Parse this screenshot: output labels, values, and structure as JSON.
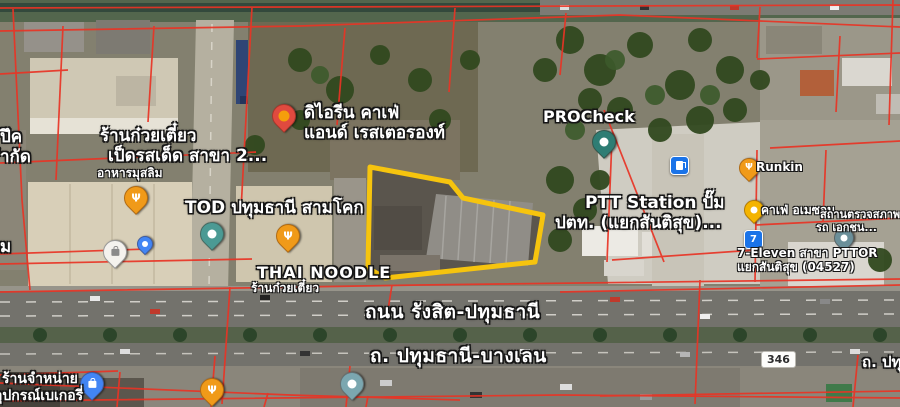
{
  "map": {
    "road_labels": {
      "primary": "ถนน รังสิต-ปทุมธานี",
      "secondary": "ถ. ปทุมธานี-บางเลน",
      "route_shield": "346",
      "partial_right": "ถ. ปทุ"
    },
    "places": {
      "cafe_irene": {
        "name_line1": "ดิไอรีน คาเฟ่",
        "name_line2": "แอนด์ เรสเตอรองท์"
      },
      "duck_noodle": {
        "name_line1": "ร้านก๋วยเตี๋ยว",
        "name_line2": "เป็ดรสเด็ด สาขา 2...",
        "subtitle": "อาหารมุสลิม"
      },
      "left_partial": {
        "line1": "ปึค",
        "line2": "ำกัด",
        "line3": "ม"
      },
      "tod": {
        "name": "TOD ปทุมธานี สามโคก"
      },
      "thai_noodle": {
        "name": "THAI NOODLE",
        "subtitle": "ร้านก๋วยเตี๋ยว"
      },
      "procheck": {
        "name": "PROCheck"
      },
      "ptt_station": {
        "name_line1": "PTT Station ปั๊ม",
        "name_line2": "ปตท. (แยกสันติสุข)..."
      },
      "runkin": {
        "name": "Runkin"
      },
      "cafe_amazon": {
        "name": "คาเฟ่ อเมซอน"
      },
      "inspection": {
        "name_line1": "สถานตรวจสภาพ",
        "name_line2": "รถ เอกชน..."
      },
      "seven_eleven": {
        "name_line1": "7-Eleven สาขา PTTOR",
        "name_line2": "แยกสันติสุข (04527)"
      },
      "bakery_supply": {
        "name_line1": "ร้านจำหน่าย",
        "name_line2": "อุปกรณ์เบเกอรี่"
      }
    },
    "colors": {
      "parcel_line": "#e93425",
      "highlight_outline": "#f6c40e"
    }
  }
}
